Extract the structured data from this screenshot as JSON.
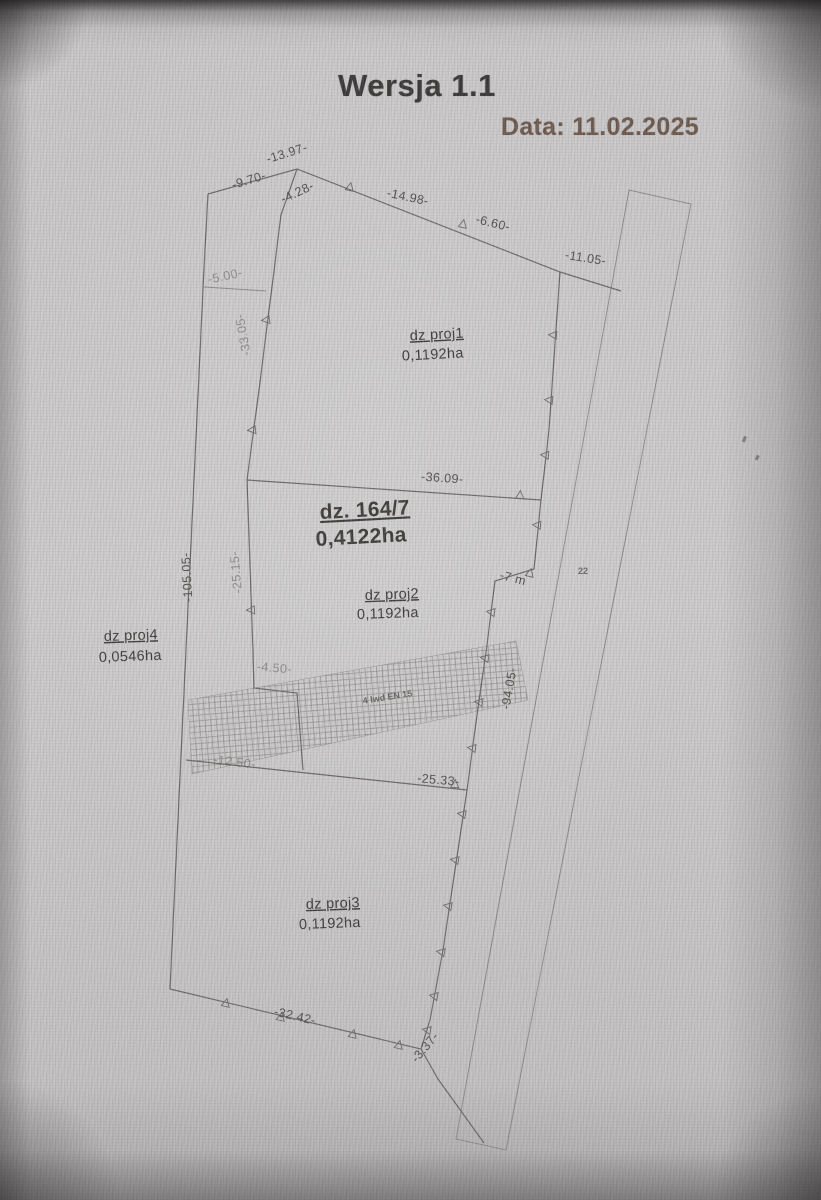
{
  "header": {
    "title": "Wersja 1.1",
    "date": "Data: 11.02.2025"
  },
  "plan": {
    "parcels": [
      {
        "name": "dz proj1",
        "area": "0,1192ha"
      },
      {
        "name": "dz. 164/7",
        "area": "0,4122ha"
      },
      {
        "name": "dz proj2",
        "area": "0,1192ha"
      },
      {
        "name": "dz proj4",
        "area": "0,0546ha"
      },
      {
        "name": "dz proj3",
        "area": "0,1192ha"
      }
    ],
    "dims": {
      "d13_97": "-13.97-",
      "d9_70": "-9.70-",
      "d4_28": "-4.28-",
      "d14_98": "-14.98-",
      "d6_60": "-6.60-",
      "d11_05": "-11.05-",
      "d5_00": "-5.00-",
      "d33_05": "-33.05-",
      "d36_09": "-36.09-",
      "d105_05": "-105.05-",
      "d25_15": "-25.15-",
      "d7m": "-7 m",
      "d94_05": "-94.05-",
      "d4_50": "-4.50-",
      "d12_50": "-12.50-",
      "d25_33": "-25.33-",
      "d32_42": "-32.42-",
      "d3_37": "-3.37-"
    },
    "notes": {
      "hatch_note": "4 lwd EN 15",
      "small_right": "22"
    }
  },
  "colors": {
    "line": "#6e6c6a",
    "label_text": "#55524f",
    "title_text": "#3b3a39",
    "date_text": "#6e5b50",
    "background": "#c7c5c6"
  }
}
